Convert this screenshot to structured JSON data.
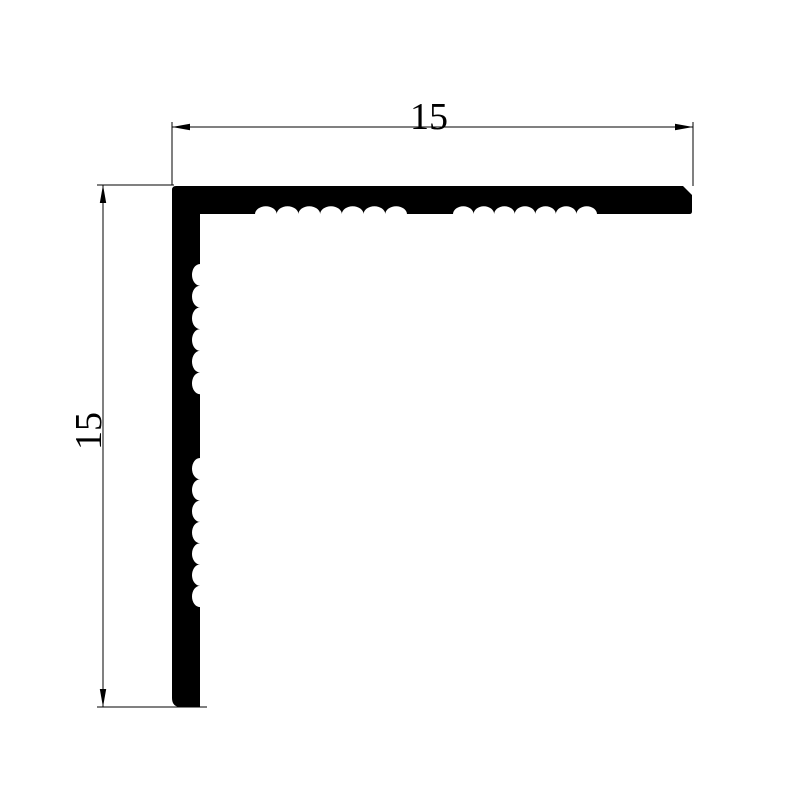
{
  "drawing": {
    "type": "technical-profile-drawing",
    "description": "L-angle profile cross-section, 15 x 15, black fill on white, serrated inner faces",
    "dimensions": {
      "top": {
        "label": "15"
      },
      "left": {
        "label": "15"
      }
    },
    "colors": {
      "background": "#ffffff",
      "profile_fill": "#000000",
      "line_color": "#000000",
      "text_color": "#000000"
    },
    "geometry": {
      "corner": {
        "x": 172,
        "y": 186
      },
      "thickness": 28,
      "inner_x": 200,
      "base_y": 214,
      "right_end_x": 692,
      "bottom_end_y": 707,
      "corner_radius": 4,
      "end_chamfer": 9,
      "end_radius": 2.5,
      "bottom_radius": 9,
      "wave_depth": 8,
      "h_groups": [
        {
          "start": 255,
          "count": 7,
          "period": 21.71
        },
        {
          "start": 453,
          "count": 7,
          "period": 20.57
        }
      ],
      "v_groups": [
        {
          "start": 264,
          "count": 6,
          "period": 21.7
        },
        {
          "start": 458,
          "count": 7,
          "period": 21.3
        }
      ],
      "top_dimension": {
        "line": {
          "x1": 172,
          "y1": 127,
          "x2": 693,
          "y2": 127
        },
        "ext_left": {
          "x1": 172,
          "y1": 122,
          "x2": 172,
          "y2": 185
        },
        "ext_right": {
          "x1": 693,
          "y1": 122,
          "x2": 693,
          "y2": 186
        },
        "label_x": 429,
        "label_y": 129
      },
      "left_dimension": {
        "line": {
          "x1": 103,
          "y1": 185,
          "x2": 103,
          "y2": 707
        },
        "ext_top": {
          "x1": 97,
          "y1": 185,
          "x2": 174,
          "y2": 185
        },
        "ext_bottom": {
          "x1": 97,
          "y1": 707,
          "x2": 207,
          "y2": 707
        },
        "label_x": 101,
        "label_y": 431
      },
      "arrow": {
        "length": 18,
        "half_width": 3.2
      },
      "arrows": [
        {
          "name": "top-left",
          "tip": [
            172,
            127
          ],
          "dir": [
            1,
            0
          ]
        },
        {
          "name": "top-right",
          "tip": [
            693,
            127
          ],
          "dir": [
            -1,
            0
          ]
        },
        {
          "name": "left-top",
          "tip": [
            103,
            185
          ],
          "dir": [
            0,
            1
          ]
        },
        {
          "name": "left-bottom",
          "tip": [
            103,
            707
          ],
          "dir": [
            0,
            -1
          ]
        }
      ]
    }
  }
}
